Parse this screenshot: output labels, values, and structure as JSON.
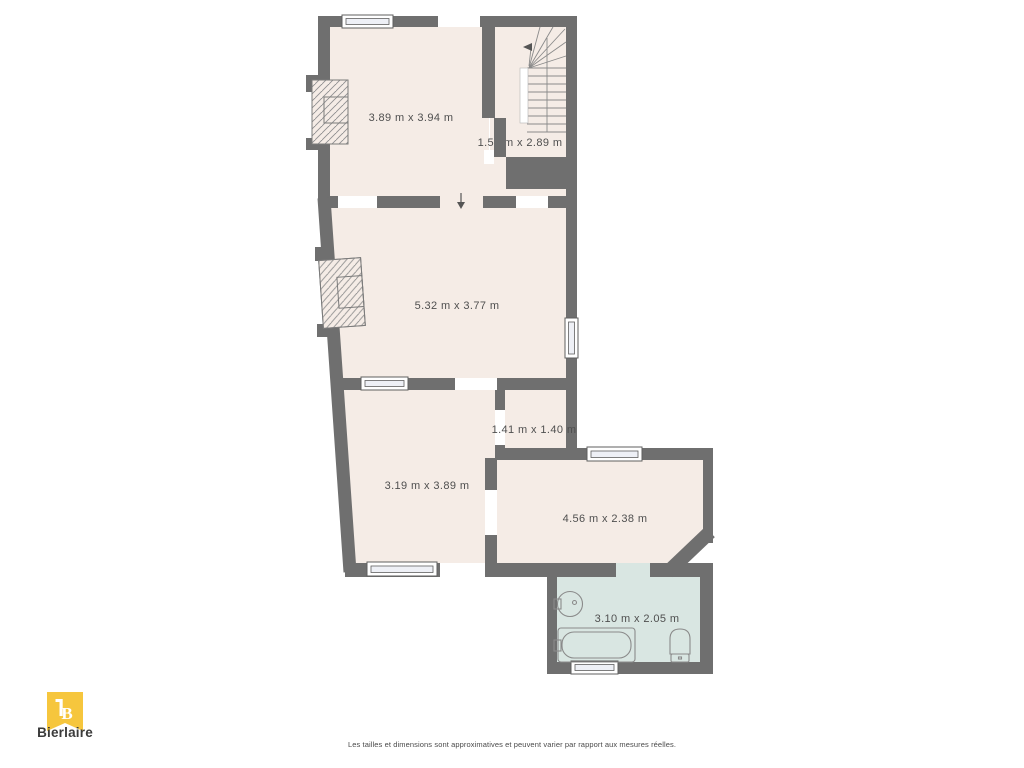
{
  "colors": {
    "page_bg": "#ffffff",
    "wall": "#6f6f6f",
    "floor": "#f5ece6",
    "bathroom_floor": "#d9e6e2",
    "window_line": "#5f5f5f",
    "fixture_line": "#8a8a8a",
    "label_text": "#4f4f4f",
    "logo_yellow": "#f6c63d"
  },
  "floorplan": {
    "rooms": [
      {
        "id": "room-top",
        "dimensions": "3.89 m x 3.94 m"
      },
      {
        "id": "stairwell",
        "dimensions": "1.58 m x 2.89 m"
      },
      {
        "id": "room-middle",
        "dimensions": "5.32 m x 3.77 m"
      },
      {
        "id": "room-lower-left",
        "dimensions": "3.19 m x 3.89 m"
      },
      {
        "id": "corridor",
        "dimensions": "1.41 m x 1.40 m"
      },
      {
        "id": "room-right",
        "dimensions": "4.56 m x 2.38 m"
      },
      {
        "id": "bathroom",
        "dimensions": "3.10 m x 2.05 m"
      }
    ]
  },
  "branding": {
    "logo_monogram": "B",
    "logo_text": "Bierlaire"
  },
  "footer": {
    "disclaimer": "Les tailles et dimensions sont approximatives et peuvent varier par rapport aux mesures réelles."
  }
}
